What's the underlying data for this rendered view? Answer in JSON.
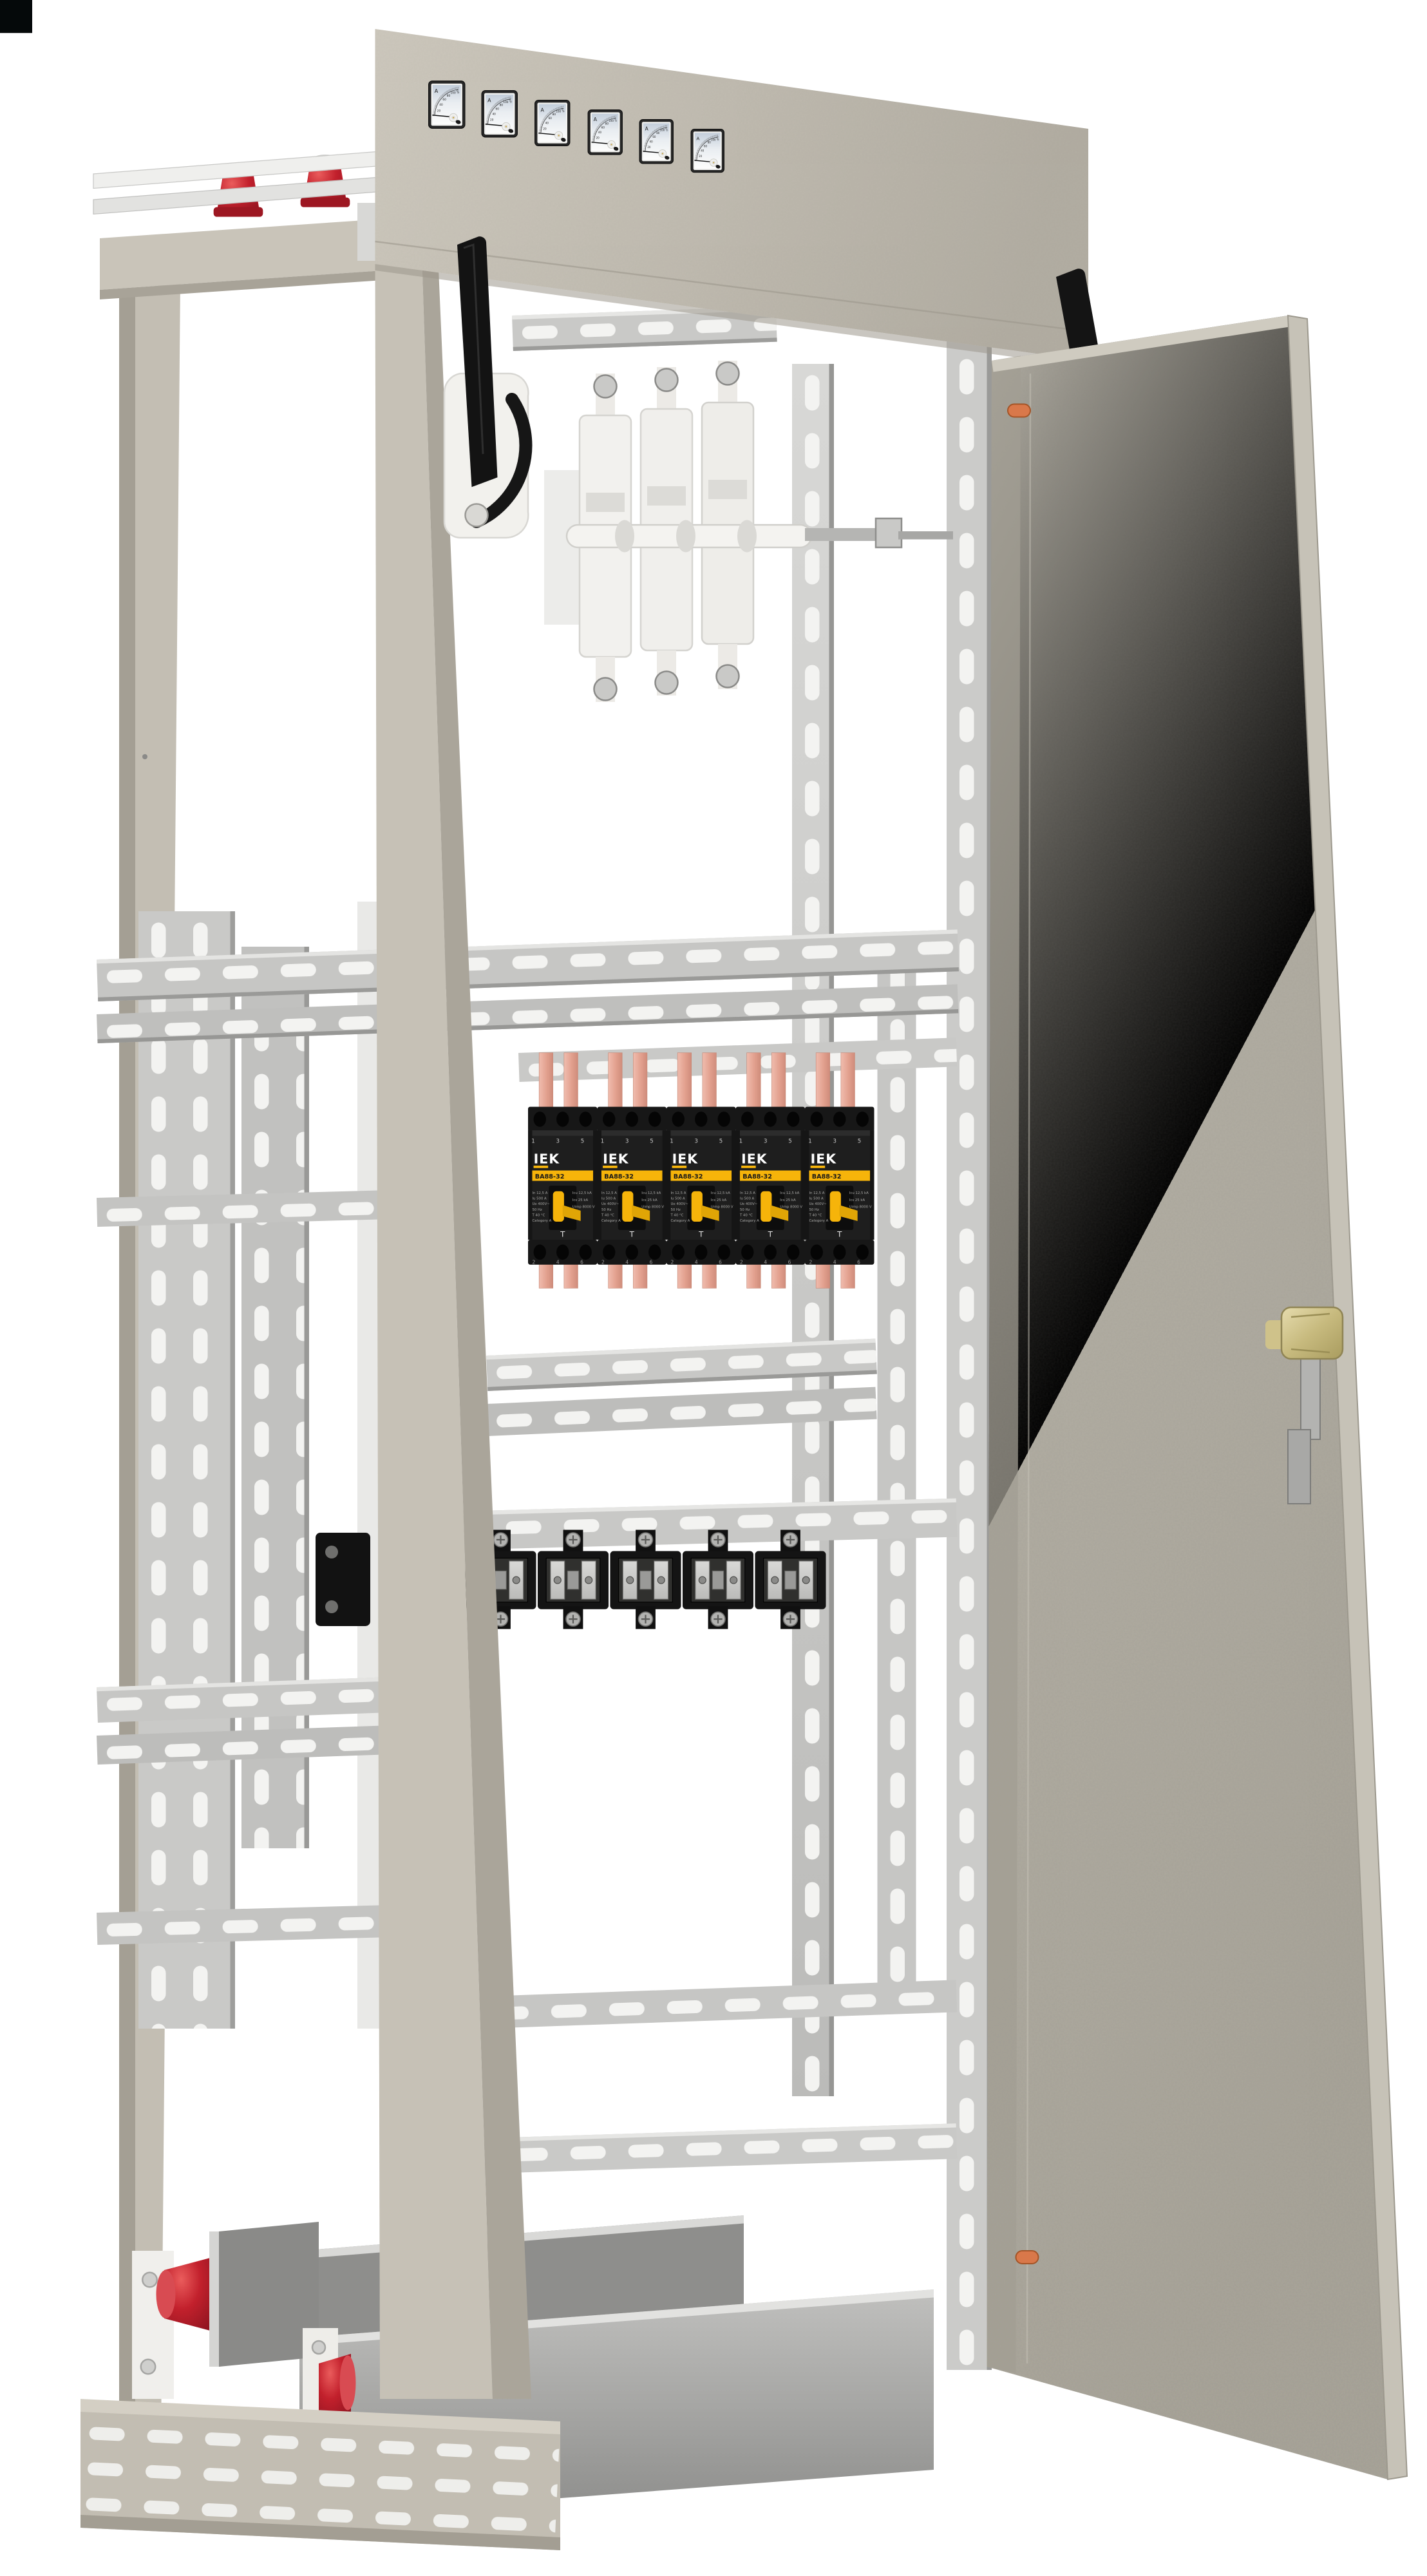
{
  "scene": {
    "subject": "Floor-standing electrical distribution cabinet with open door, analog ammeters and IEK breakers",
    "background_color": "#ffffff",
    "corner_artifact_color": "#05090a"
  },
  "meter_panel": {
    "instrument_count": 6,
    "unit_label": "A",
    "scale_labels": [
      "20",
      "40",
      "60",
      "80",
      "100",
      "200"
    ]
  },
  "breaker_row": {
    "count": 5,
    "brand": "IEK",
    "model": "ВА88-32",
    "top_terminal_numbers": "1 3 5",
    "bottom_terminal_numbers": "2 4 6",
    "test_mark": "T",
    "spec_left": [
      "In 12,5 A",
      "Iu 500 A",
      "Ue 400V~",
      "50 Hz",
      "T 40 °C",
      "Category A"
    ],
    "spec_right": [
      "Icu 12,5 kA",
      "Ics 25 kA",
      "Uimp 8000 V"
    ],
    "body_color": "#1e1e1e",
    "accent_color": "#f6b40a",
    "busbar_color": "#e4a390"
  },
  "fuse_row": {
    "count": 6,
    "body_color": "#141414"
  },
  "switch": {
    "pole_count": 3,
    "handle_color": "#141414",
    "bracket_color": "#f2f1ed"
  },
  "cabinet": {
    "frame_color": "#c2bdb2",
    "panel_color": "#c6c1b6",
    "door_color": "#b4b0a5",
    "galvanized_color": "#c7c7c5",
    "slot_color": "#f3f3f1",
    "insulator_color": "#c2202c",
    "lock_color": "#cfc28a",
    "hinge_pin_color": "#d9784a",
    "trough_color": "#9a9a98"
  }
}
